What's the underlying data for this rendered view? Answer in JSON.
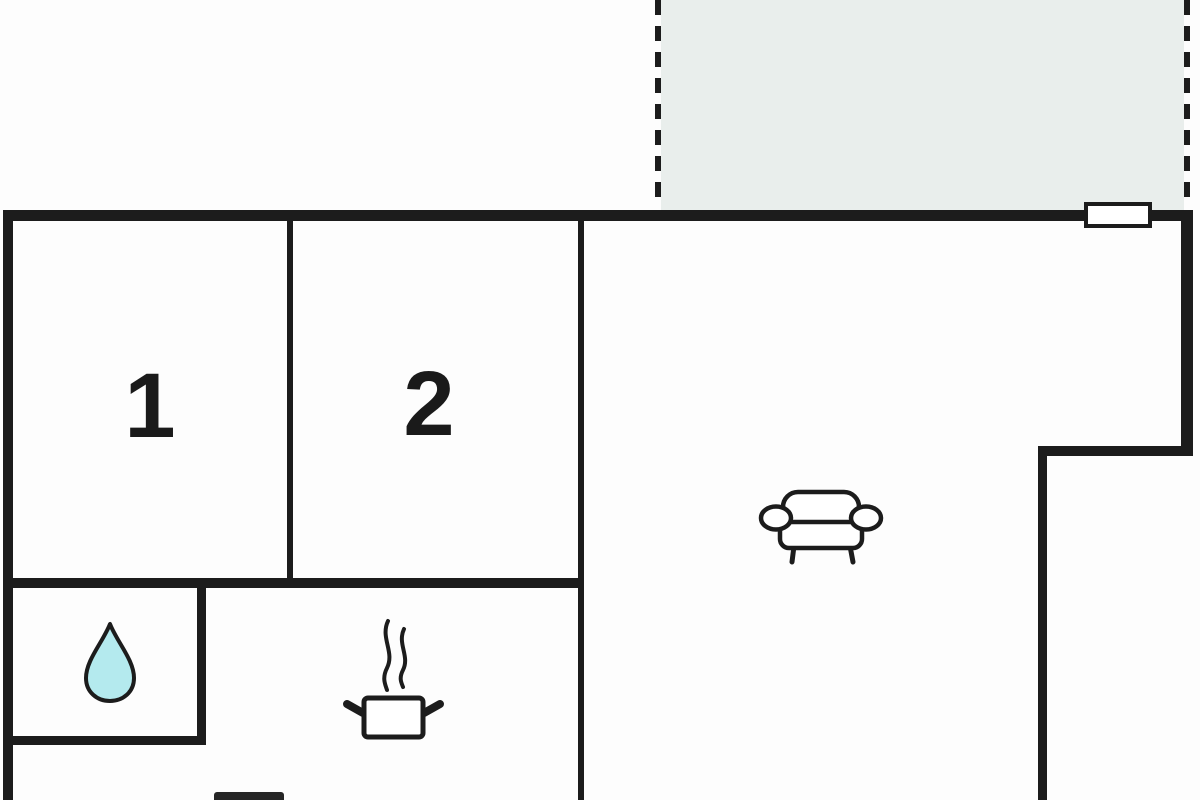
{
  "plan": {
    "type": "apartment-floor-plan",
    "rooms": [
      {
        "id": "room-1",
        "label": "1"
      },
      {
        "id": "room-2",
        "label": "2"
      }
    ],
    "icons": {
      "sofa": "sofa-icon",
      "cooking_pot": "cooking-pot-icon",
      "water_drop": "water-drop-icon",
      "window": "window-marker",
      "terrace": "terrace-dashed-area",
      "appliance": "appliance-block"
    }
  },
  "colors": {
    "background": "#fdfdfd",
    "wall": "#1c1c1c",
    "label": "#1a1a1a",
    "terrace_fill": "#e9eeec",
    "water_fill": "#b4eaee",
    "appliance": "#262626"
  }
}
